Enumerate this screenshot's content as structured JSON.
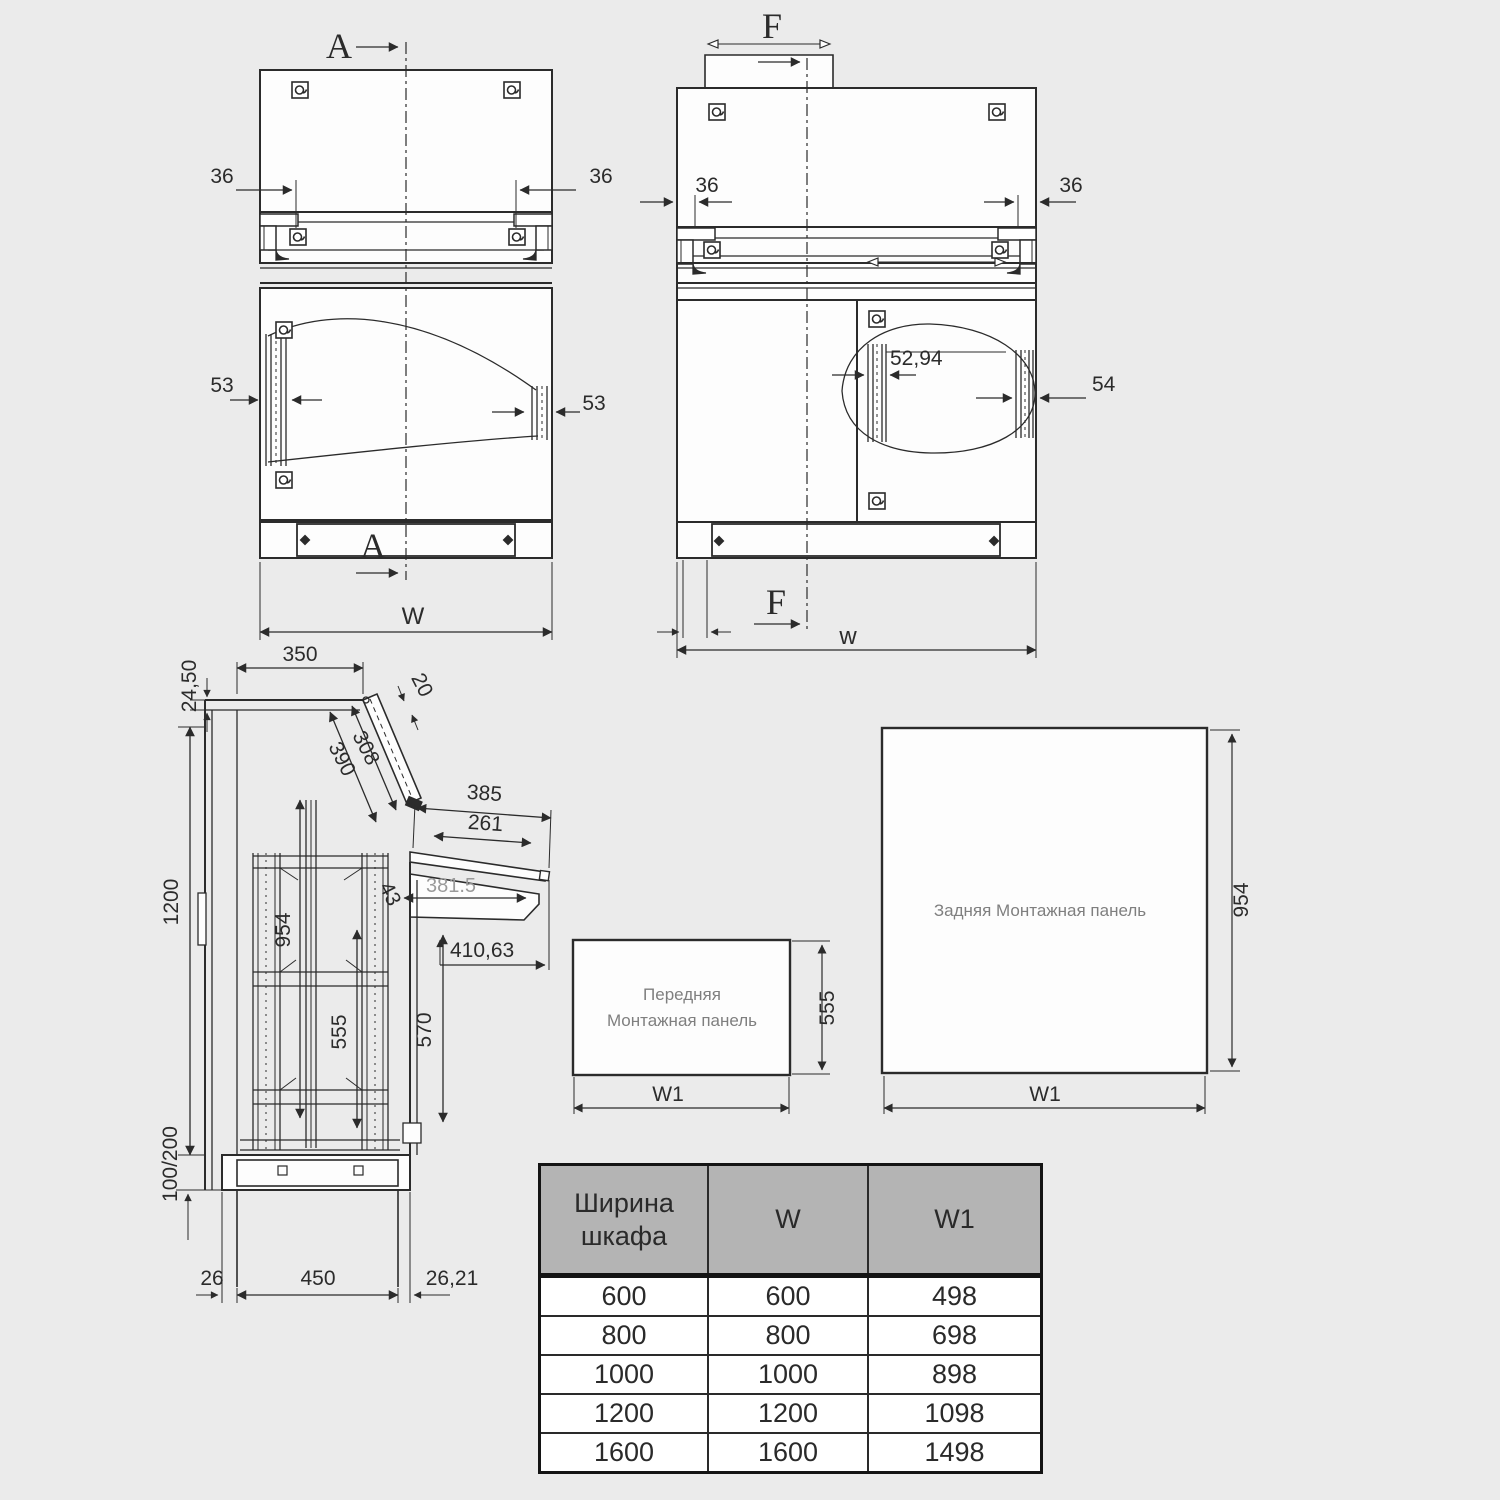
{
  "front_view_a": {
    "section_top": "A",
    "section_bottom": "A",
    "dim_left_36": "36",
    "dim_right_36": "36",
    "dim_left_53": "53",
    "dim_right_53": "53",
    "dim_width": "W"
  },
  "front_view_f": {
    "section_top": "F",
    "section_bottom": "F",
    "dim_left_36": "36",
    "dim_right_36": "36",
    "dim_rail_5294": "52,94",
    "dim_rail_54": "54",
    "dim_width": "w"
  },
  "side_view": {
    "dim_2450": "24,50",
    "dim_350": "350",
    "dim_20": "20",
    "dim_308": "308",
    "dim_390": "390",
    "dim_385": "385",
    "dim_261": "261",
    "dim_3815": "381.5",
    "dim_41063": "410,63",
    "dim_43": "43",
    "dim_954": "954",
    "dim_555": "555",
    "dim_570": "570",
    "dim_1200": "1200",
    "dim_100_200": "100/200",
    "dim_26": "26",
    "dim_450": "450",
    "dim_2621": "26,21"
  },
  "front_panel": {
    "title_line1": "Передняя",
    "title_line2": "Монтажная панель",
    "dim_height": "555",
    "dim_width": "W1"
  },
  "rear_panel": {
    "title": "Задняя Монтажная панель",
    "dim_height": "954",
    "dim_width": "W1"
  },
  "table": {
    "col_headers": [
      "Ширина шкафа",
      "W",
      "W1"
    ],
    "rows": [
      [
        "600",
        "600",
        "498"
      ],
      [
        "800",
        "800",
        "698"
      ],
      [
        "1000",
        "1000",
        "898"
      ],
      [
        "1200",
        "1200",
        "1098"
      ],
      [
        "1600",
        "1600",
        "1498"
      ]
    ]
  }
}
